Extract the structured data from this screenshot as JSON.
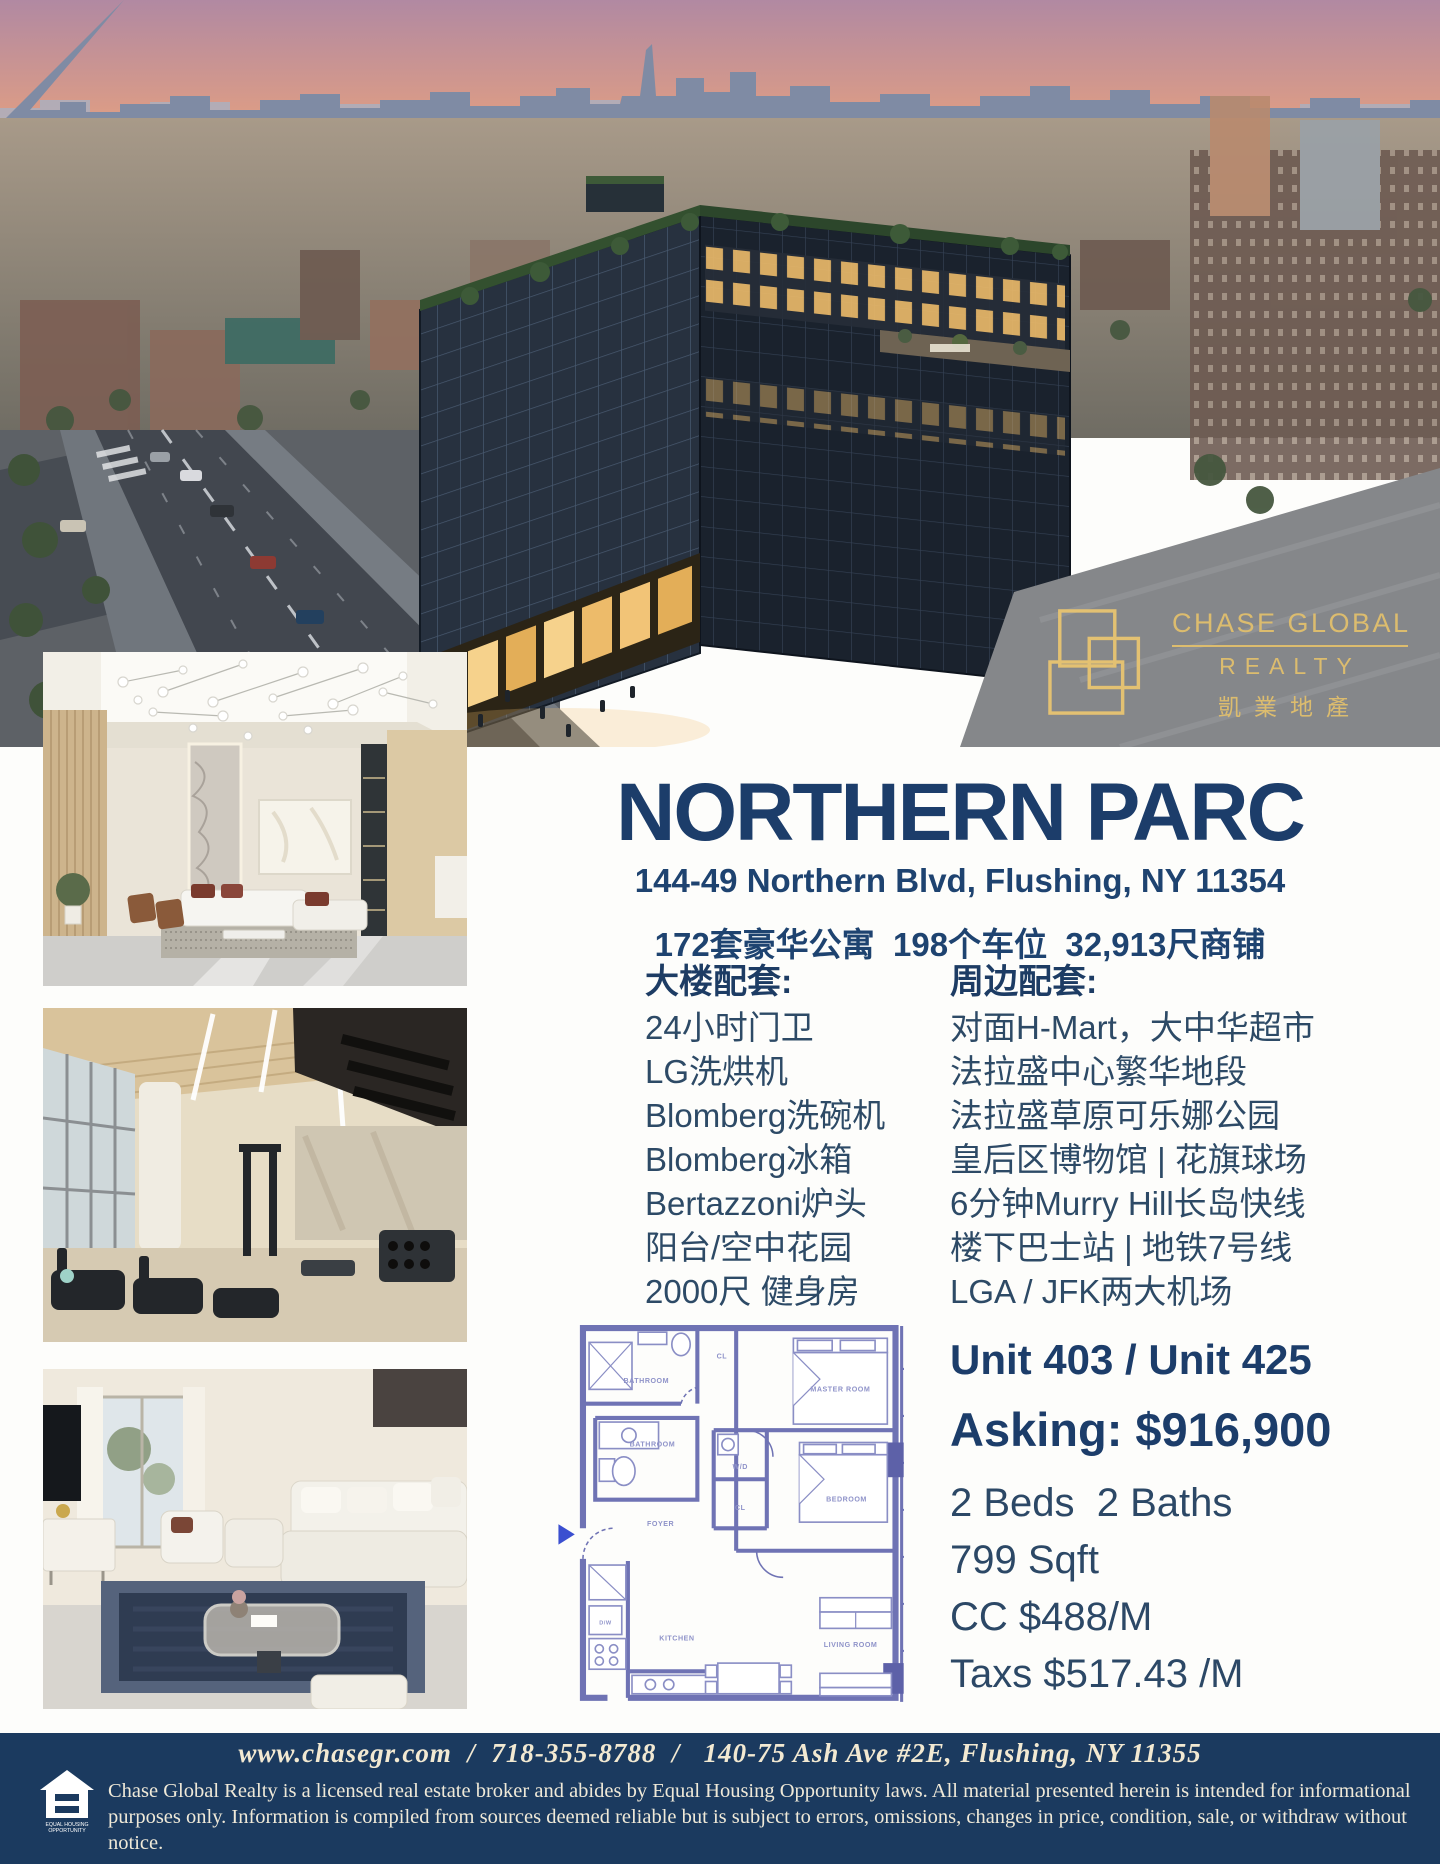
{
  "brand": {
    "name_line1": "CHASE GLOBAL",
    "name_line2": "REALTY",
    "name_cn": "凱業地產",
    "gold": "#dcbc6e"
  },
  "listing": {
    "title": "NORTHERN PARC",
    "address": "144-49 Northern Blvd, Flushing, NY 11354",
    "stats": "172套豪华公寓  198个车位  32,913尺商铺"
  },
  "amenities_building": {
    "heading": "大楼配套:",
    "items": [
      "24小时门卫",
      "LG洗烘机",
      "Blomberg洗碗机",
      "Blomberg冰箱",
      "Bertazzoni炉头",
      "阳台/空中花园",
      "2000尺 健身房"
    ]
  },
  "amenities_area": {
    "heading": "周边配套:",
    "items": [
      "对面H-Mart，大中华超市",
      "法拉盛中心繁华地段",
      "法拉盛草原可乐娜公园",
      "皇后区博物馆 | 花旗球场",
      "6分钟Murry Hill长岛快线",
      "楼下巴士站 | 地铁7号线",
      "LGA / JFK两大机场"
    ]
  },
  "unit": {
    "units": "Unit 403 / Unit 425",
    "asking": "Asking: $916,900",
    "beds_baths": "2 Beds  2 Baths",
    "sqft": "799 Sqft",
    "cc": "CC $488/M",
    "taxes": "Taxs $517.43 /M"
  },
  "floorplan": {
    "labels": {
      "bathroom1": "BATHROOM",
      "bathroom2": "BATHROOM",
      "master": "MASTER ROOM",
      "bedroom": "BEDROOM",
      "wd": "W/D",
      "cl1": "CL",
      "cl2": "CL",
      "foyer": "FOYER",
      "kitchen": "KITCHEN",
      "living": "LIVING ROOM",
      "dw": "D/W"
    }
  },
  "footer": {
    "contact": "www.chasegr.com  /  718-355-8788  /   140-75 Ash Ave #2E, Flushing, NY 11355",
    "disclaimer": "Chase Global Realty is a licensed real estate broker and abides by Equal Housing Opportunity laws. All material presented herein is intended for informational purposes only. Information is compiled from sources deemed reliable but is subject to errors, omissions, changes in price, condition, sale, or withdraw without notice.",
    "equal_housing": "EQUAL HOUSING OPPORTUNITY"
  },
  "colors": {
    "navy_heading": "#1c3d6a",
    "text_slate": "#2d4a66",
    "footer_navy": "#1b3a5f",
    "gold": "#dcbc6e",
    "floorplan_purple": "#6f73b4"
  }
}
